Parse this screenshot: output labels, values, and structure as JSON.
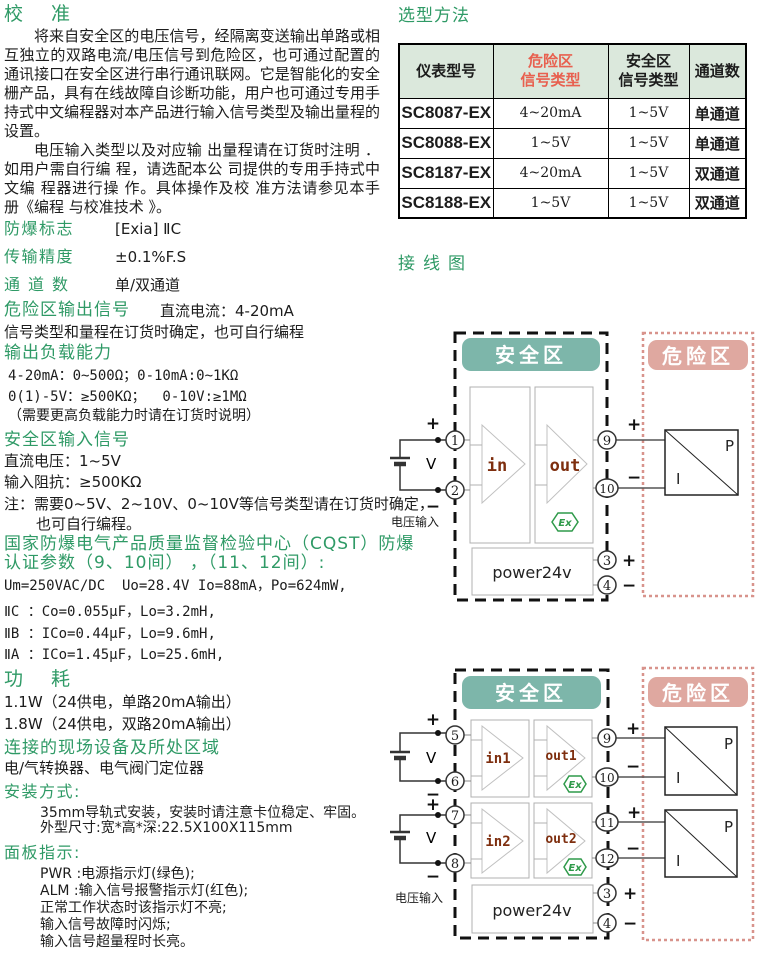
{
  "left": {
    "heading": "校准",
    "para1": "将来自安全区的电压信号，经隔离变送输出单路或相互独立的双路电流/电压信号到危险区，也可通过配置的通讯接口在安全区进行串行通讯联网。它是智能化的安全栅产品，具有在线故障自诊断功能，用户也可通过专用手持式中文编程器对本产品进行输入信号类型及输出量程的设置。",
    "para2": "电压输入类型以及对应输 出量程请在订货时注明 ．如用户需自行编 程，请选配本公 司提供的专用手持式中文编 程器进行操 作。具体操作及校 准方法请参见本手 册《编程 与校准技术 》。",
    "explosion_mark_label": "防爆标志",
    "explosion_mark_value": "[Exia] ⅡC",
    "accuracy_label": "传输精度",
    "accuracy_value": "±0.1%F.S",
    "channels_label": "通道数",
    "channels_value": "单/双通道",
    "hazard_output_label": "危险区输出信号",
    "hazard_output_value": "直流电流：4-20mA",
    "hazard_output_note": "信号类型和量程在订货时确定，也可自行编程",
    "load_heading": "输出负载能力",
    "load_line1": "4-20mA：0~500Ω；0-10mA:0~1KΩ",
    "load_line2": "0(1)-5V：≥500KΩ；  0-10V:≥1MΩ",
    "load_line3": "（需要更高负载能力时请在订货时说明）",
    "safe_input_heading": "安全区输入信号",
    "safe_input_line1": "直流电压：1~5V",
    "safe_input_line2": "输入阻抗：≥500KΩ",
    "safe_input_note1": "注：需要0~5V、2~10V、0~10V等信号类型请在订货时确定，",
    "safe_input_note2": "也可自行编程。",
    "cqst_heading1": "国家防爆电气产品质量监督检验中心（CQST）防爆",
    "cqst_heading2": "认证参数（9、10间） ，（11、12间）:",
    "cqst_line1": "Um=250VAC/DC  Uo=28.4V Io=88mA，Po=624mW,",
    "cqst_line2": "ⅡC ：Co=0.055μF，Lo=3.2mH,",
    "cqst_line3": "ⅡB ：ICo=0.44μF，Lo=9.6mH,",
    "cqst_line4": "ⅡA ：ICo=1.45μF，Lo=25.6mH,",
    "power_heading": "功耗",
    "power_line1": "1.1W（24供电，单路20mA输出）",
    "power_line2": "1.8W（24供电，双路20mA输出）",
    "devices_heading": "连接的现场设备及所处区域",
    "devices_line": "电/气转换器、电气阀门定位器",
    "mount_heading": "安装方式:",
    "mount_line1": "35mm导轨式安装，安装时请注意卡位稳定、牢固。",
    "mount_line2": "外型尺寸:宽*高*深:22.5X100X115mm",
    "panel_heading": "面板指示:",
    "panel_line1": "PWR :电源指示灯(绿色);",
    "panel_line2": "ALM :输入信号报警指示灯(红色);",
    "panel_line3": "正常工作状态时该指示灯不亮;",
    "panel_line4": "输入信号故障时闪烁;",
    "panel_line5": "输入信号超量程时长亮。"
  },
  "right": {
    "selection_heading": "选型方法",
    "table": {
      "col1": "仪表型号",
      "col2_l1": "危险区",
      "col2_l2": "信号类型",
      "col3_l1": "安全区",
      "col3_l2": "信号类型",
      "col4": "通道数",
      "rows": [
        {
          "model": "SC8087-EX",
          "hazard": "4~20mA",
          "safe": "1~5V",
          "channels": "单通道"
        },
        {
          "model": "SC8088-EX",
          "hazard": "1~5V",
          "safe": "1~5V",
          "channels": "单通道"
        },
        {
          "model": "SC8187-EX",
          "hazard": "4~20mA",
          "safe": "1~5V",
          "channels": "双通道"
        },
        {
          "model": "SC8188-EX",
          "hazard": "1~5V",
          "safe": "1~5V",
          "channels": "双通道"
        }
      ]
    },
    "wiring_heading": "接线图",
    "labels": {
      "safe_zone": "安全区",
      "hazard_zone": "危险区",
      "voltage_input": "电压输入",
      "power": "power24v",
      "v": "V",
      "plus": "+",
      "minus": "−",
      "p": "P",
      "i": "I",
      "ex": "Ex",
      "in": "in",
      "out": "out",
      "in1": "in1",
      "out1": "out1",
      "in2": "in2",
      "out2": "out2"
    },
    "d1_terminals": {
      "t1": "1",
      "t2": "2",
      "t3": "3",
      "t4": "4",
      "t9": "9",
      "t10": "10"
    },
    "d2_terminals": {
      "t3": "3",
      "t4": "4",
      "t5": "5",
      "t6": "6",
      "t7": "7",
      "t8": "8",
      "t9": "9",
      "t10": "10",
      "t11": "11",
      "t12": "12"
    }
  },
  "colors": {
    "heading_green": "#2f9a66",
    "table_header_bg": "#dbe8dc",
    "table_header_red": "#e8604f",
    "safe_zone_teal": "#7db6aa",
    "hazard_zone_pink": "#dfa8a0",
    "hazard_border_pink": "#d8938c",
    "amp_label_brown": "#7e2e0e",
    "ex_green": "#2f9a4a"
  }
}
